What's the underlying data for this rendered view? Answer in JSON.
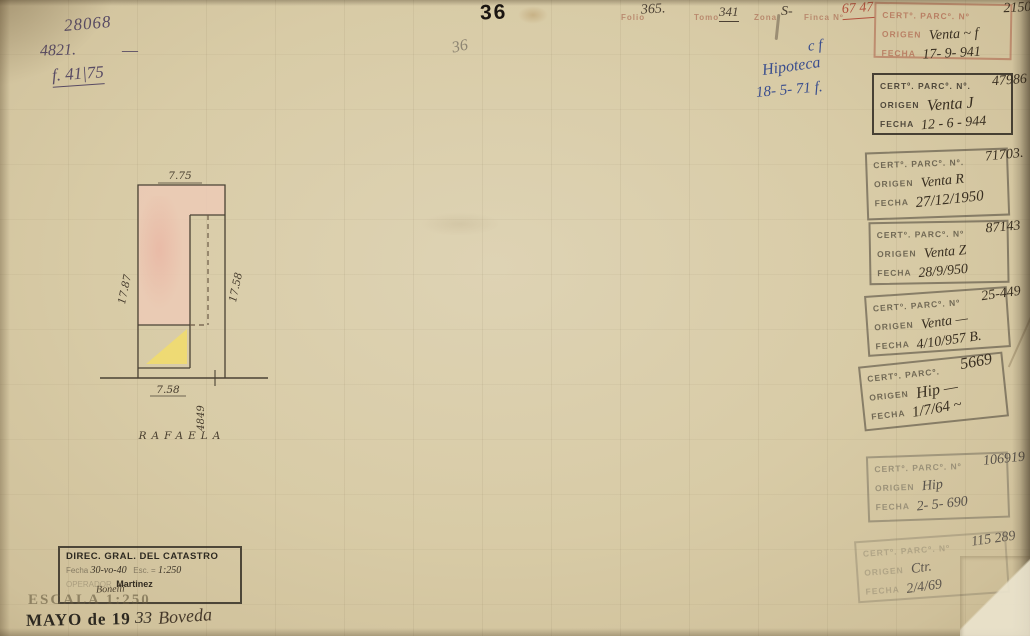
{
  "annotations": {
    "top_number": "28068",
    "file_number": "4821.",
    "dash": "—",
    "folio_ref": "f. 41|75",
    "page_number_bold": "36",
    "page_number_pencil": "36",
    "hipoteca_line1": "c f",
    "hipoteca_line2": "Hipoteca",
    "hipoteca_line3": "18- 5- 71 f."
  },
  "header": {
    "folio_label": "Folio",
    "folio_value": "365.",
    "tomo_label": "Tomo",
    "tomo_value": "341",
    "zona_label": "Zona",
    "zona_value": "S-",
    "finca_label": "Finca Nº",
    "finca_value": "67 47"
  },
  "plot": {
    "top_dim": "7.75",
    "left_dim": "17.87",
    "right_dim": "17.58",
    "bottom_dim": "7.58",
    "street_number": "4849",
    "street_name": "RAFAELA",
    "pink_color": "#eccab6",
    "yellow_color": "#f0dc6e",
    "line_color": "#4a4234"
  },
  "stamps": [
    {
      "no_label": "CERTº. PARCº. Nº",
      "number": "21504",
      "origen_label": "ORIGEN",
      "origen": "Venta ~ f",
      "fecha_label": "FECHA",
      "fecha": "17- 9- 941"
    },
    {
      "no_label": "CERTº. PARCº. Nº.",
      "number": "47986",
      "origen_label": "ORIGEN",
      "origen": "Venta J",
      "fecha_label": "FECHA",
      "fecha": "12 - 6 - 944"
    },
    {
      "no_label": "CERTº. PARCº. Nº.",
      "number": "71703.",
      "origen_label": "ORIGEN",
      "origen": "Venta  R",
      "fecha_label": "FECHA",
      "fecha": "27/12/1950"
    },
    {
      "no_label": "CERTº. PARCº. Nº",
      "number": "87143",
      "origen_label": "ORIGEN",
      "origen": "Venta Z",
      "fecha_label": "FECHA",
      "fecha": "28/9/950"
    },
    {
      "no_label": "CERTº. PARCº. Nº",
      "number": "25-449",
      "origen_label": "ORIGEN",
      "origen": "Venta —",
      "fecha_label": "FECHA",
      "fecha": "4/10/957 B."
    },
    {
      "no_label": "CERTº. PARCº.",
      "number": "5669",
      "origen_label": "ORIGEN",
      "origen": "Hip —",
      "fecha_label": "FECHA",
      "fecha": "1/7/64 ~"
    },
    {
      "no_label": "CERTº. PARCº. Nº",
      "number": "106919",
      "origen_label": "ORIGEN",
      "origen": "Hip",
      "fecha_label": "FECHA",
      "fecha": "2- 5- 690"
    },
    {
      "no_label": "CERTº. PARCº. Nº",
      "number": "115 289",
      "origen_label": "ORIGEN",
      "origen": "Ctr.",
      "fecha_label": "FECHA",
      "fecha": "2/4/69"
    }
  ],
  "catastro_stamp": {
    "title": "DIREC. GRAL. DEL CATASTRO",
    "fecha_label": "Fecha",
    "fecha_value": "30-vo-40",
    "esc_label": "Esc. =",
    "esc_value": "1:250",
    "operador_label": "OPERADOR",
    "operador_value": "Martinez"
  },
  "footer": {
    "surveyor": "Bonelli",
    "escala": "ESCALA 1:250",
    "date_printed": "MAYO de 19",
    "date_hand": "33",
    "signature": "Boveda"
  }
}
